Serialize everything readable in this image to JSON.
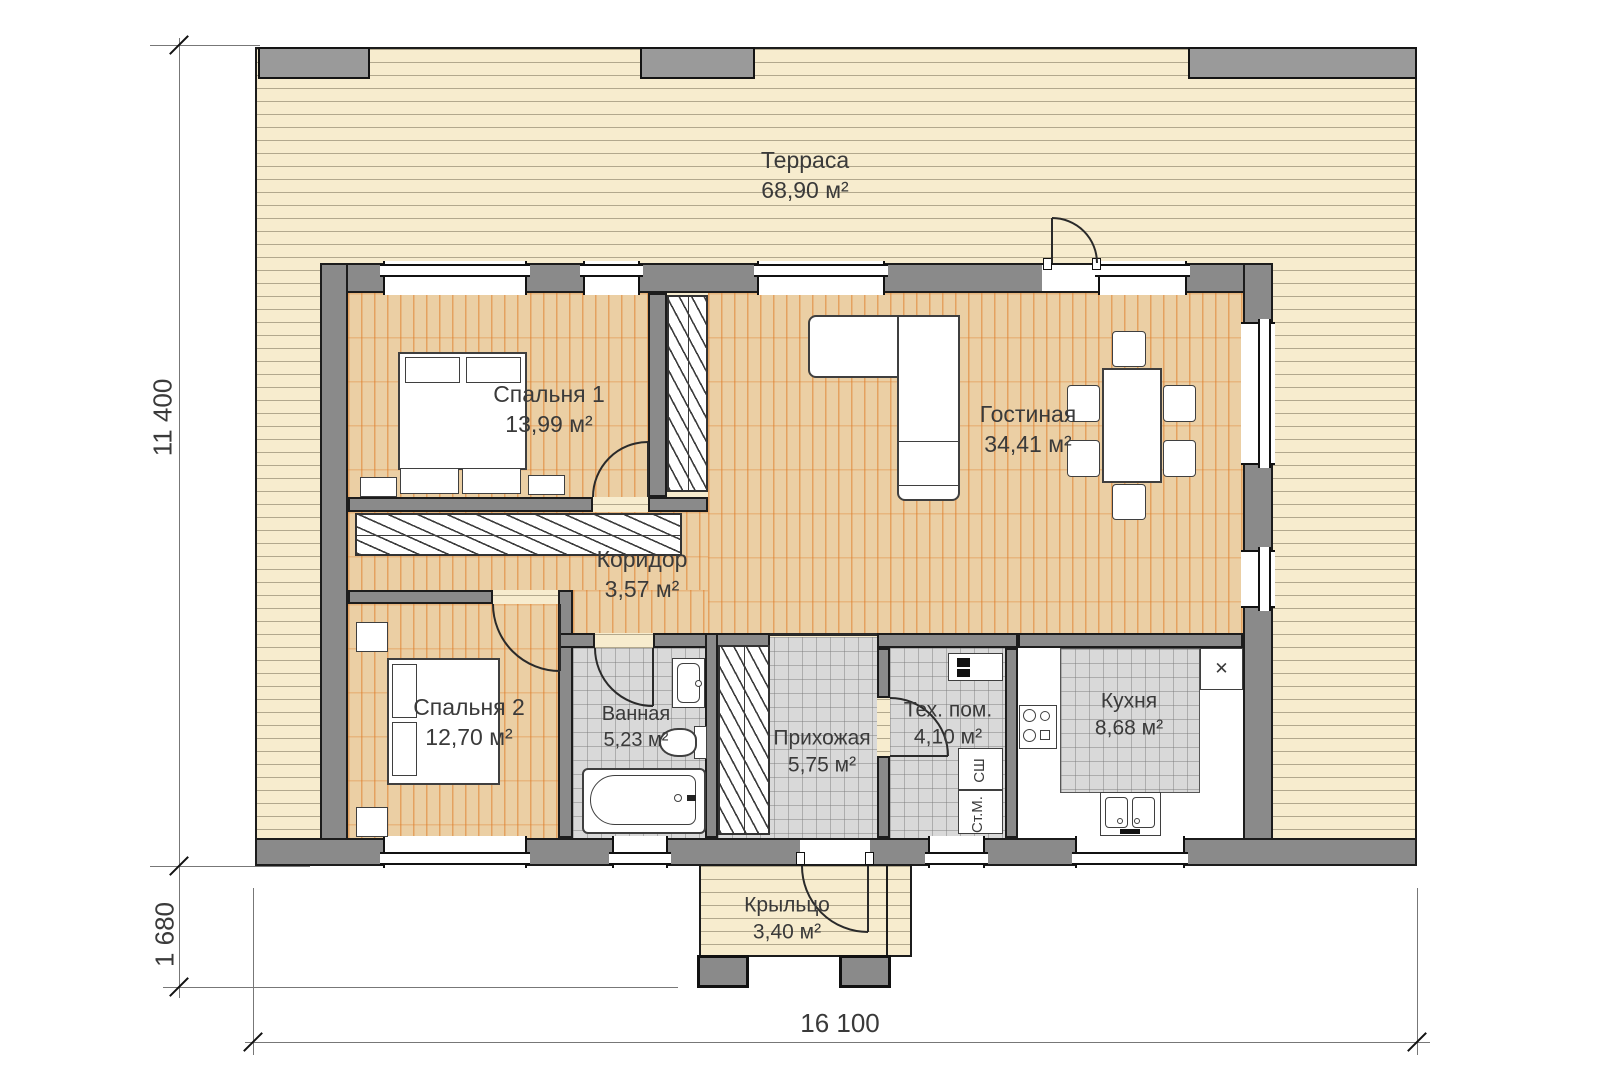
{
  "title": "floor-plan",
  "rooms": [
    {
      "id": "terrace",
      "name": "Терраса",
      "area": "68,90 м²"
    },
    {
      "id": "bedroom1",
      "name": "Спальня 1",
      "area": "13,99 м²"
    },
    {
      "id": "living",
      "name": "Гостиная",
      "area": "34,41 м²"
    },
    {
      "id": "corridor",
      "name": "Коридор",
      "area": "3,57 м²"
    },
    {
      "id": "bedroom2",
      "name": "Спальня 2",
      "area": "12,70 м²"
    },
    {
      "id": "bathroom",
      "name": "Ванная",
      "area": "5,23 м²"
    },
    {
      "id": "hallway",
      "name": "Прихожая",
      "area": "5,75 м²"
    },
    {
      "id": "techroom",
      "name": "Тех. пом.",
      "area": "4,10 м²"
    },
    {
      "id": "kitchen",
      "name": "Кухня",
      "area": "8,68 м²"
    },
    {
      "id": "porch",
      "name": "Крыльцо",
      "area": "3,40 м²"
    }
  ],
  "dimensions": {
    "side_height": "11 400",
    "porch_depth": "1 680",
    "total_width": "16 100"
  },
  "labels": {
    "washer": "Ст.М.",
    "dryer": "СШ",
    "vent_mark": "✕"
  },
  "colors": {
    "terrace_deck": "#f7ecce",
    "parquet": "#ebcfa4",
    "parquet_line": "#de7c28",
    "tile": "#d9d9d9",
    "wall": "#8a8a8a",
    "text": "#3a3a3a"
  }
}
